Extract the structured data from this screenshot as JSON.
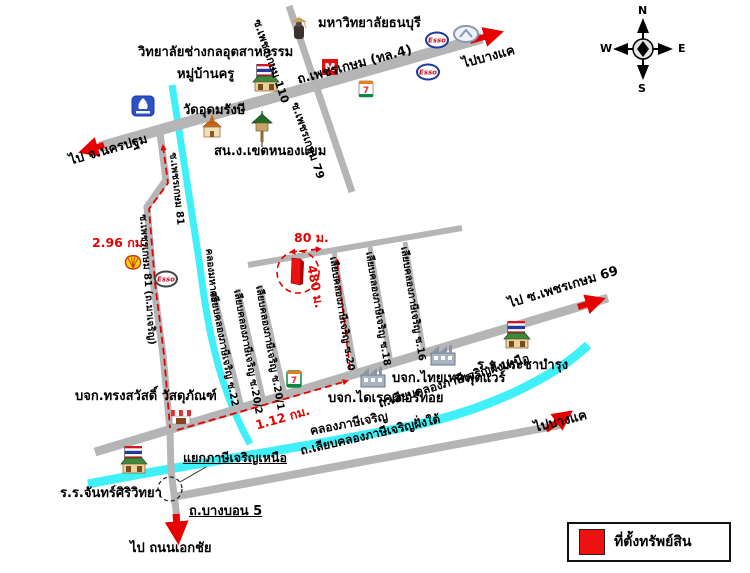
{
  "compass": {
    "n": "N",
    "e": "E",
    "s": "S",
    "w": "W"
  },
  "roads": {
    "phetkasem": "ถ.เพชรเกษม (ทล.4)",
    "soi_110": "ซ.เพชรเกษม 110",
    "soi_79": "ซ.เพชรเกษม 79",
    "soi_81": "ซ.เพชรเกษม 81",
    "soi_81_full": "ซ.เพชรเกษม 81 (ถ.มาเจริญ)",
    "liap_khlong_nuea": "ถ.เลียบคลองภาษีเจริญฝั่งเหนือ",
    "liap_khlong_tai": "ถ.เลียบคลองภาษีเจริญฝั่งใต้",
    "bang_bon_5": "ถ.บางบอน 5",
    "soi_liap_16": "เลียบคลองภาษีเจริญ ซ.16",
    "soi_liap_18": "เลียบคลองภาษีเจริญ ซ.18",
    "soi_liap_20": "เลียบคลองภาษีเจริญ ซ.20",
    "soi_liap_20_1": "เลียบคลองภาษีเจริญ ซ.20/1",
    "soi_liap_20_2": "เลียบคลองภาษีเจริญ ซ.20/2",
    "soi_liap_22": "เลียบคลองภาษีเจริญ ซ.22"
  },
  "canals": {
    "phasi_charoen": "คลองภาษีเจริญ",
    "mahason": "คลองมหาศร"
  },
  "directions": {
    "to_nakhon_pathom": "ไป จ.นครปฐม",
    "to_bang_khae_top": "ไปบางแค",
    "to_bang_khae_bottom": "ไปบางแค",
    "to_phetkasem_69": "ไป ซ.เพชรเกษม 69",
    "to_ekkachai": "ไป ถนนเอกชัย"
  },
  "places": {
    "college": "วิทยาลัยช่างกลอุตสาหกรรม",
    "mu_ban_khru": "หมู่บ้านครู",
    "thonburi_university": "มหาวิทยาลัยธนบุรี",
    "wat_udom_rangsi": "วัดอุดมรังษี",
    "nong_khaem_district_office": "สน.ง.เขตหนองแขม",
    "thai_tech_footwear": "บจก.ไทยเทคฟุตแวร์",
    "director_toy": "บจก.ไดเรคเตอร์ทอย",
    "prachabamrung_school": "ร.ร.ประชาบำรุง",
    "songsawat_materials": "บจก.ทรงสวัสดิ์ วัสดุภัณฑ์",
    "chansiri_school": "ร.ร.จันทร์ศิริวิทยา",
    "phasi_charoen_nuea_junction": "แยกภาษีเจริญเหนือ"
  },
  "distances": {
    "leg1": "2.96 กม.",
    "leg2": "1.12 กม.",
    "leg3": "480 ม.",
    "leg4": "80 ม."
  },
  "legend": {
    "property_location": "ที่ตั้งทรัพย์สิน"
  },
  "brands": {
    "esso": "Esso",
    "seven_eleven": "7",
    "m_mart": "M"
  },
  "colors": {
    "route": "#e80000",
    "road": "#b5b5b5",
    "canal": "#3ff0f8",
    "legend_marker": "#ee1111"
  }
}
